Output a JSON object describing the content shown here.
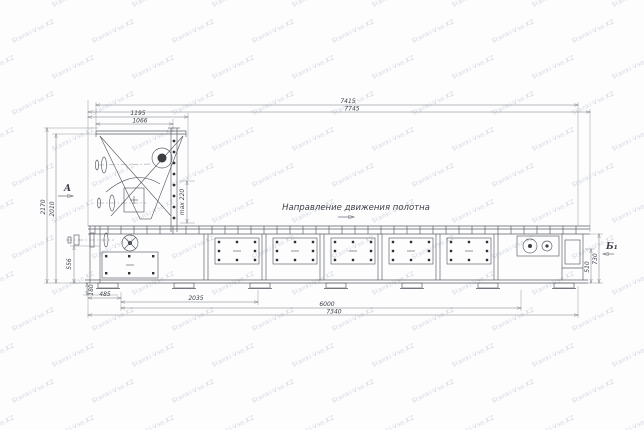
{
  "watermark": {
    "text": "Stanki-Vse.KZ",
    "color": "#c9cedb"
  },
  "drawing": {
    "direction_note": "Направление движения полотна",
    "section_a": "A",
    "section_b": "Б₁"
  },
  "dimensions": {
    "overall_length_inner": "7415",
    "overall_length_outer": "7745",
    "feeder_width_outer": "1195",
    "feeder_width_inner": "1066",
    "height_overall": "2170",
    "height_frame": "2010",
    "max_stroke": "max 220",
    "left_section_height": "556",
    "base_height": "180",
    "bottom_step1": "485",
    "bottom_step2": "2035",
    "bottom_step3": "6000",
    "bottom_step4": "7340",
    "right_height_inner": "510",
    "right_height_outer": "730"
  }
}
